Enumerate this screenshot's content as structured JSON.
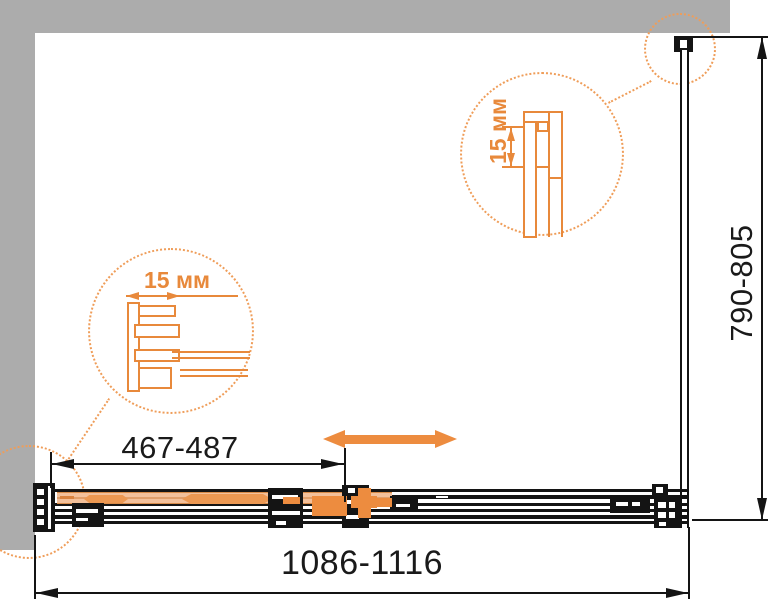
{
  "title": "Shower enclosure technical dimension drawing (plan view)",
  "dimensions": {
    "overall_width": "1086-1116",
    "side_depth": "790-805",
    "door_adjust": "467-487"
  },
  "details": {
    "top": {
      "label": "15 мм",
      "description": "magnified wall-profile detail, top-right corner"
    },
    "left": {
      "label": "15 мм",
      "description": "magnified wall-profile detail, bottom-left corner"
    }
  },
  "icons": {
    "slide_direction": "double-headed-arrow",
    "dimension_arrows": "thin-triangle-arrowheads",
    "magnifier": "dotted-detail-circle"
  },
  "colors": {
    "accent_orange": "#ED8C3F",
    "band_orange": "#F3C09A",
    "dotted_orange": "#EF9D59",
    "wall_gray": "#ACACAC",
    "line_black": "#141414",
    "background": "#FFFFFF"
  }
}
